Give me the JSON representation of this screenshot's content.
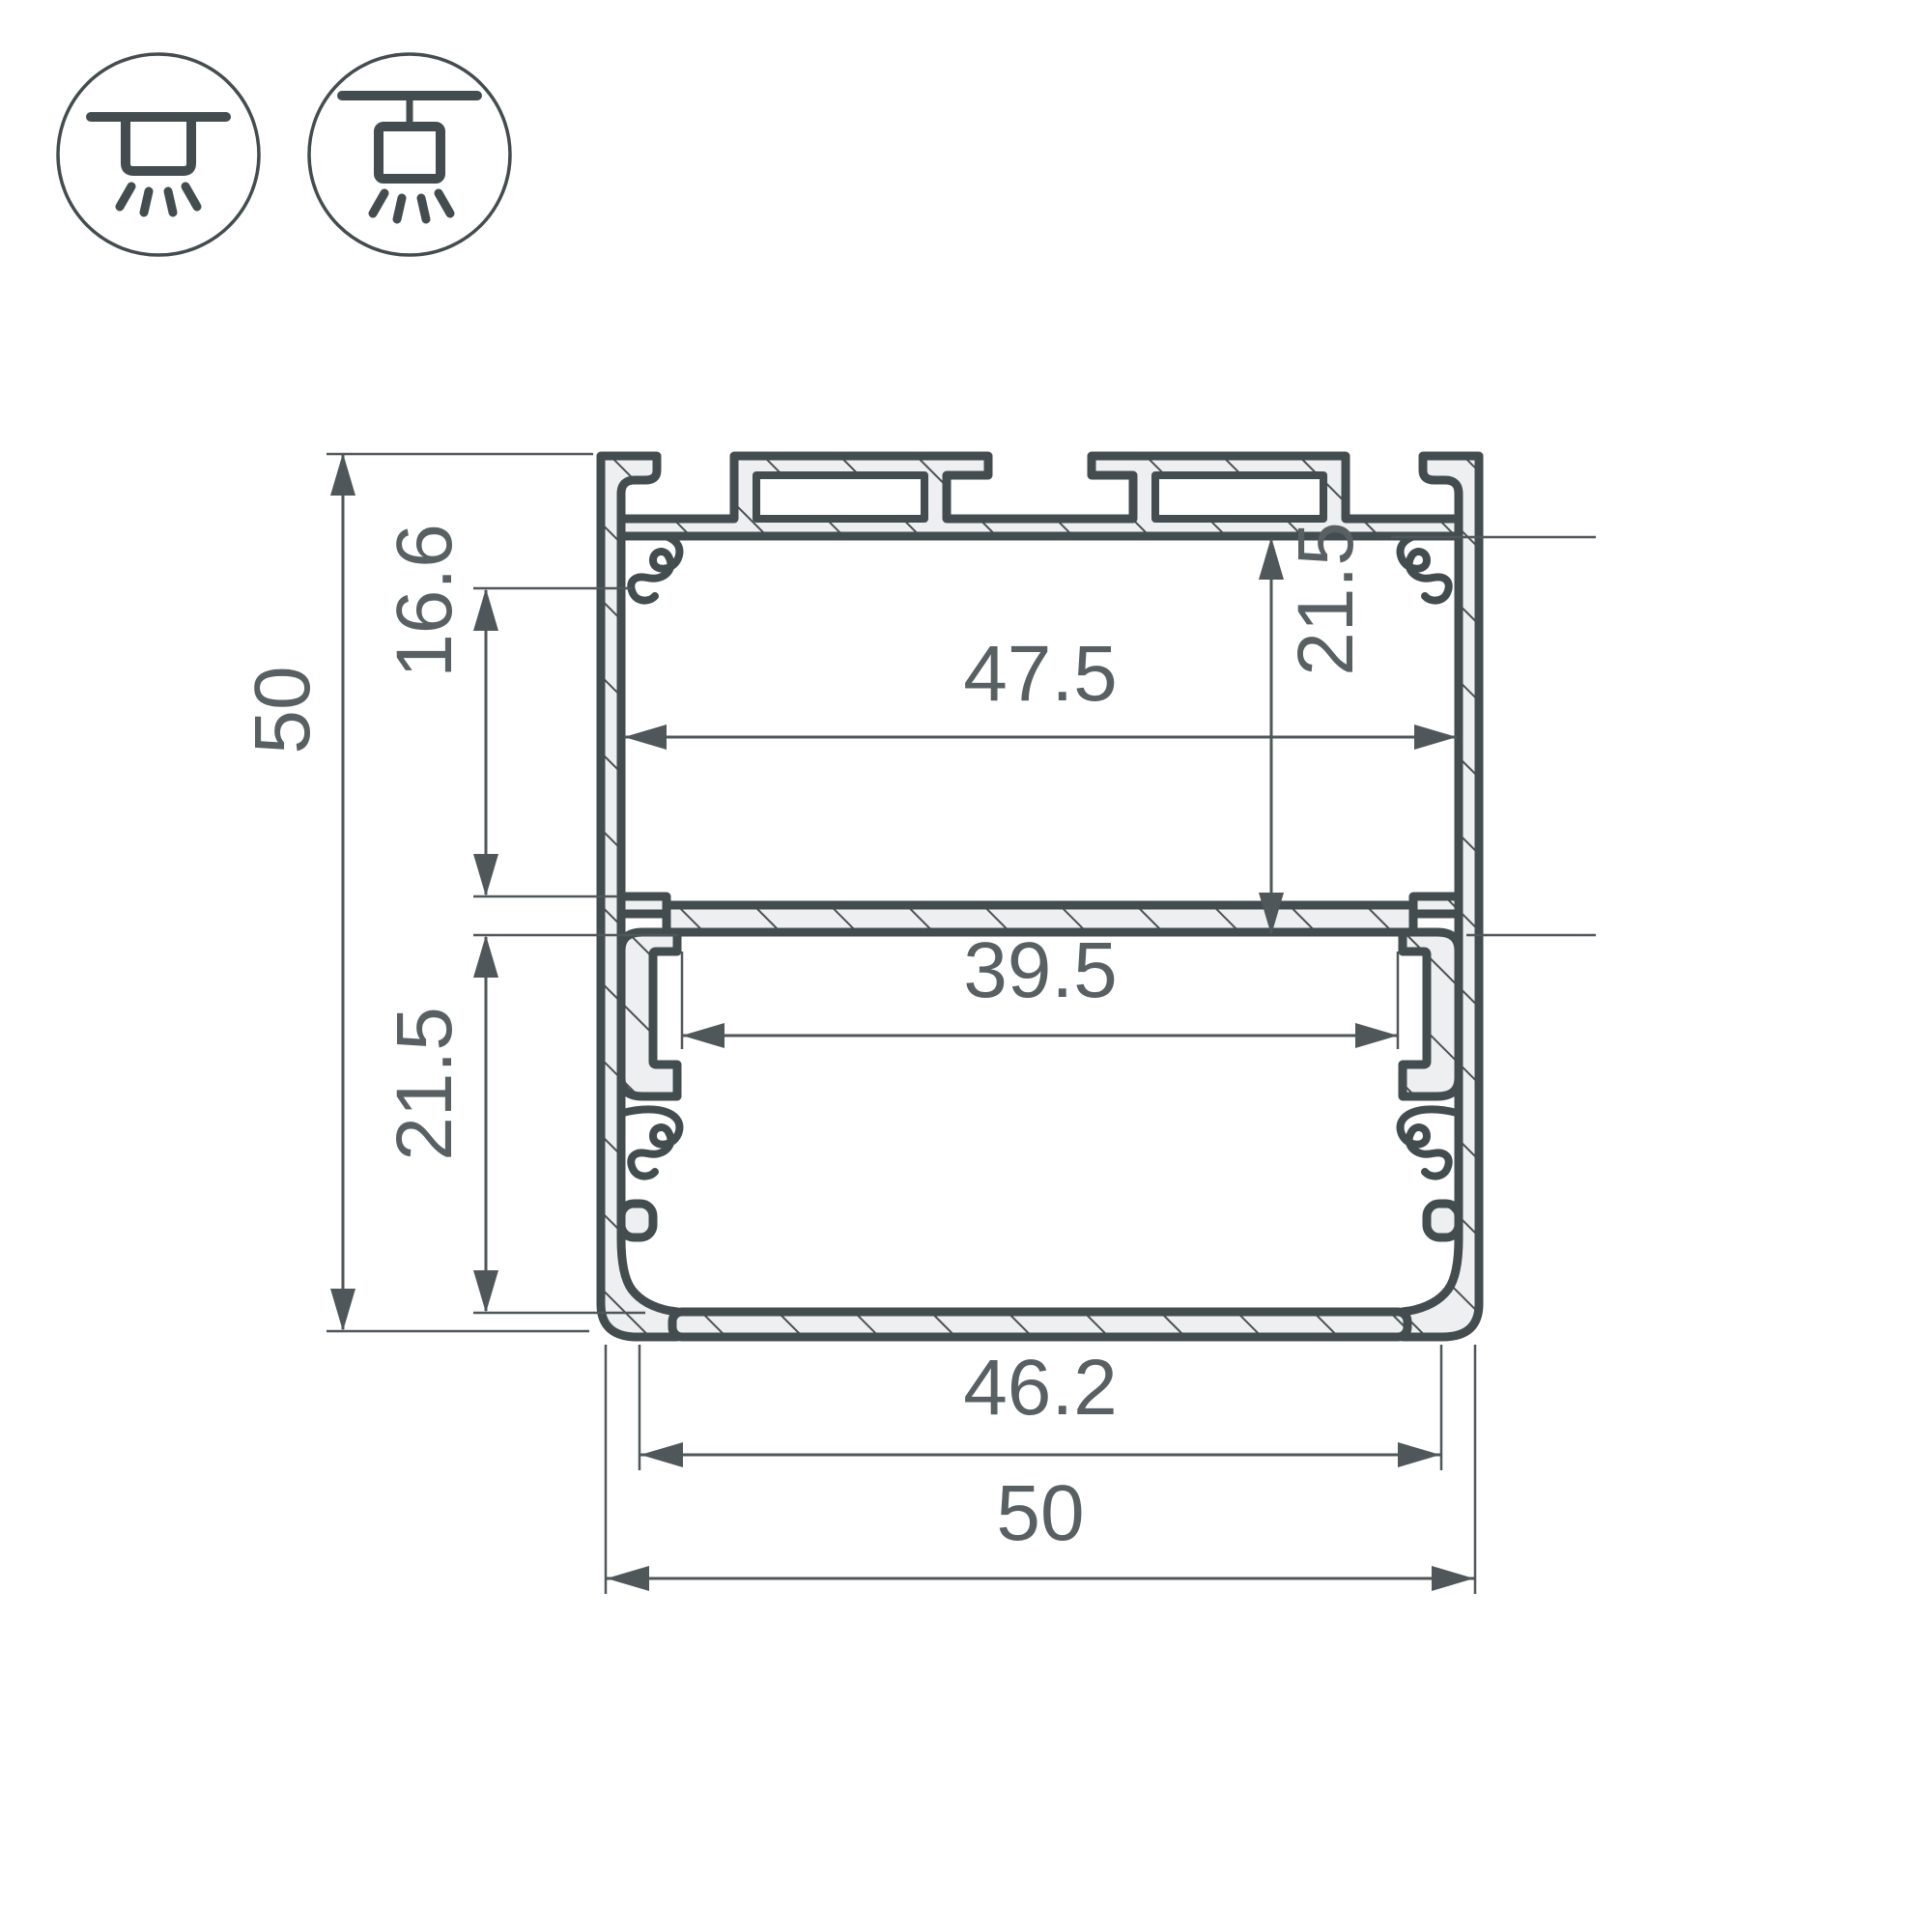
{
  "title": "Aluminium LED profile cross-section drawing",
  "icons": [
    {
      "name": "ceiling-surface-mount-icon",
      "meaning": "surface ceiling mounting, light directed down"
    },
    {
      "name": "ceiling-suspended-mount-icon",
      "meaning": "suspended ceiling mounting, light directed down"
    }
  ],
  "dimensions": {
    "overall_height": "50",
    "clip_to_shelf_height": "16.6",
    "lower_chamber_height": "21.5",
    "upper_chamber_height": "21.5",
    "top_inner_width": "47.5",
    "shelf_opening_width": "39.5",
    "bottom_inner_width": "46.2",
    "overall_width": "50"
  },
  "colors": {
    "outline": "#434c4f",
    "profile_fill": "#edeff0",
    "dimension_lines": "#4f575a",
    "dimension_text": "#586064",
    "background": "#ffffff"
  }
}
